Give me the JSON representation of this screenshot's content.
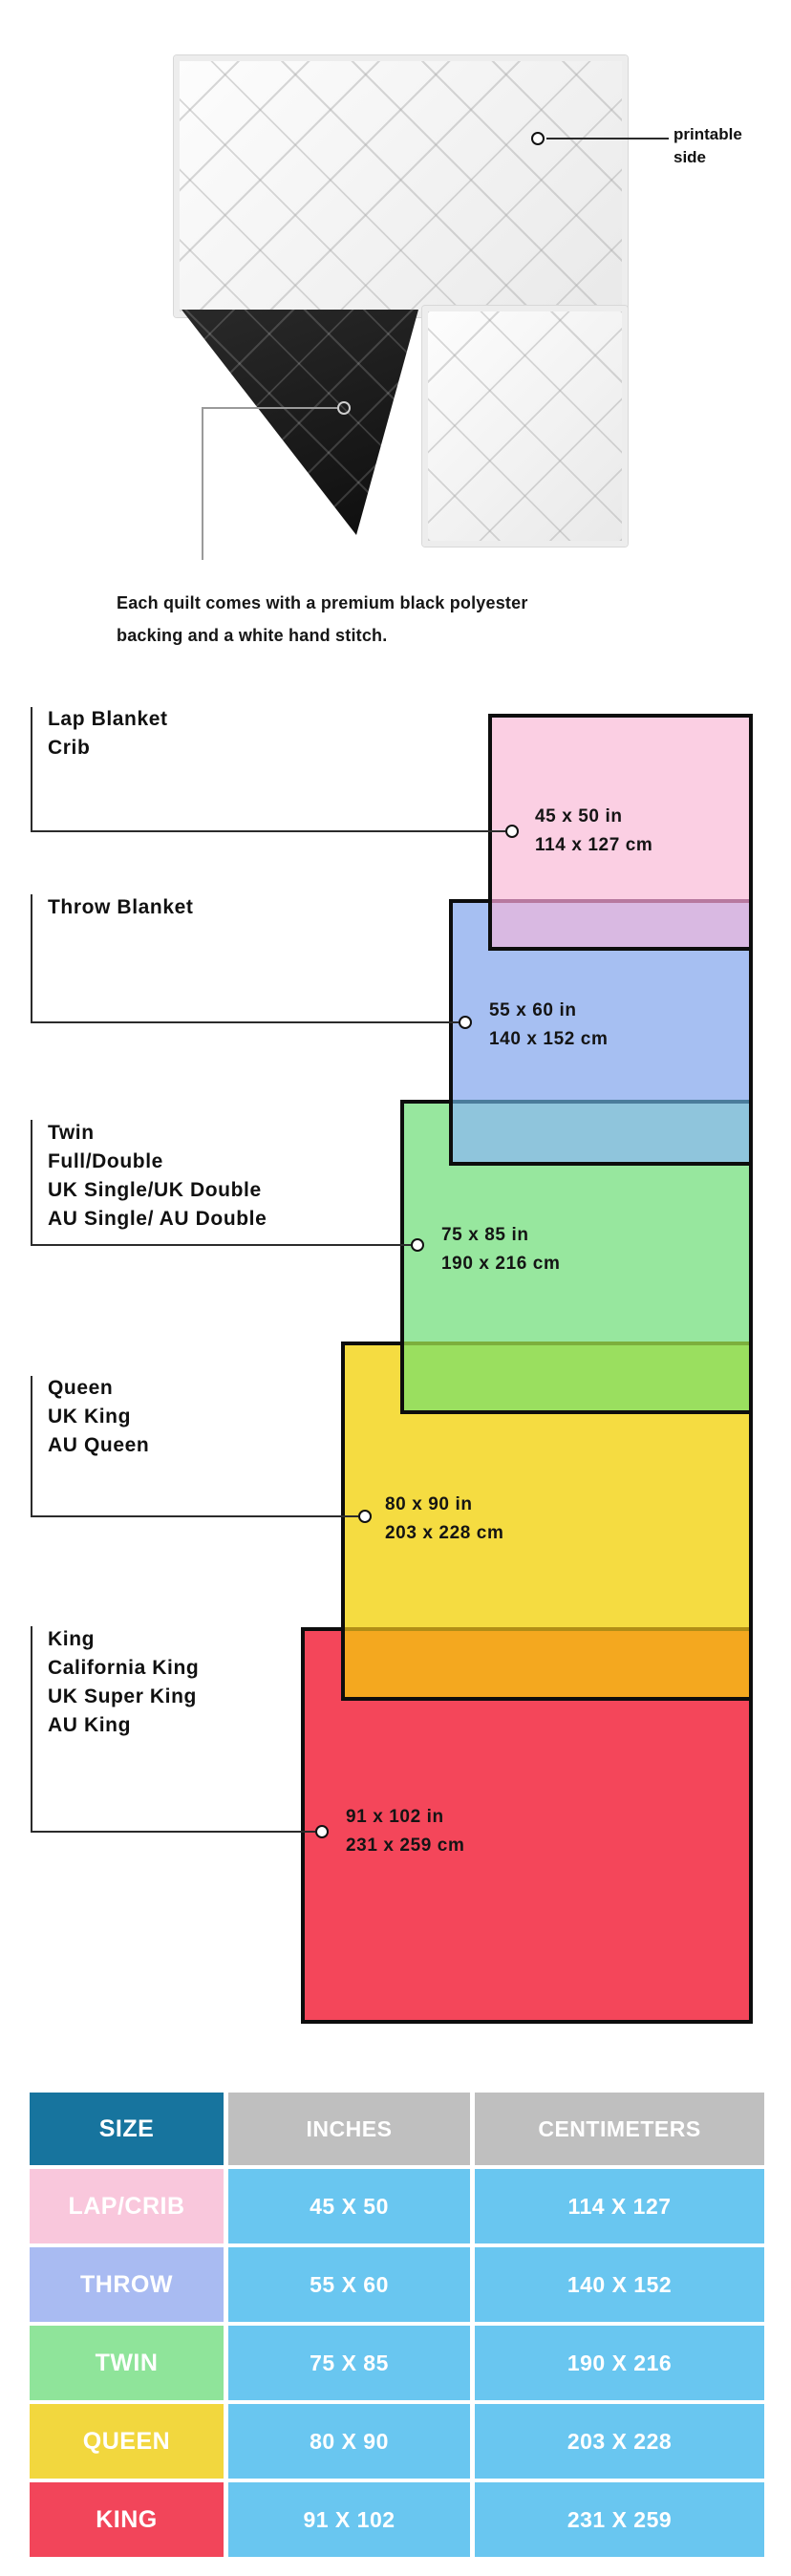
{
  "quilt": {
    "printable_label": "printable\nside",
    "caption_line1": "Each quilt comes with a premium black polyester",
    "caption_line2": "backing and a white hand stitch."
  },
  "colors": {
    "pink": "#FBCFE3",
    "blue": "#A6BFF2",
    "green": "#97E79E",
    "yellow": "#F5DC41",
    "red": "#F4465A",
    "overlap_pink_blue": "#D9B9E2",
    "overlap_blue_green": "#8FC5DC",
    "overlap_green_yellow": "#9ADF5F",
    "overlap_yellow_red": "#F4A81F",
    "covered_line_blue": "#B7799F",
    "covered_line_green": "#4A7C9B",
    "covered_line_yellow": "#7CAF3D",
    "covered_line_red": "#B18E16",
    "table_header_size_bg": "#17749E",
    "table_header_bg": "#BFBFBF",
    "table_value_bg": "#69C6F0",
    "table_row_bgs": [
      "#F9C7DC",
      "#A9BBF2",
      "#8FE49A",
      "#F2D73E",
      "#F2455A"
    ]
  },
  "sizes": [
    {
      "labels": [
        "Lap Blanket",
        "Crib",
        "",
        ""
      ],
      "inches": "45 x 50 in",
      "cm": "114 x 127 cm"
    },
    {
      "labels": [
        "Throw Blanket",
        "",
        "",
        ""
      ],
      "inches": "55 x 60 in",
      "cm": "140 x 152 cm"
    },
    {
      "labels": [
        "Twin",
        "Full/Double",
        "UK Single/UK Double",
        "AU Single/ AU Double"
      ],
      "inches": "75 x 85 in",
      "cm": "190 x 216 cm"
    },
    {
      "labels": [
        "Queen",
        "UK King",
        "AU Queen",
        ""
      ],
      "inches": "80 x 90 in",
      "cm": "203 x 228 cm"
    },
    {
      "labels": [
        "King",
        "California King",
        "UK Super King",
        "AU King"
      ],
      "inches": "91 x 102 in",
      "cm": "231 x 259 cm"
    }
  ],
  "table": {
    "headers": [
      "SIZE",
      "INCHES",
      "CENTIMETERS"
    ],
    "rows": [
      {
        "size": "LAP/CRIB",
        "inches": "45 X 50",
        "cm": "114 X 127"
      },
      {
        "size": "THROW",
        "inches": "55 X 60",
        "cm": "140 X 152"
      },
      {
        "size": "TWIN",
        "inches": "75 X 85",
        "cm": "190 X 216"
      },
      {
        "size": "QUEEN",
        "inches": "80 X 90",
        "cm": "203 X 228"
      },
      {
        "size": "KING",
        "inches": "91 X 102",
        "cm": "231 X 259"
      }
    ]
  }
}
